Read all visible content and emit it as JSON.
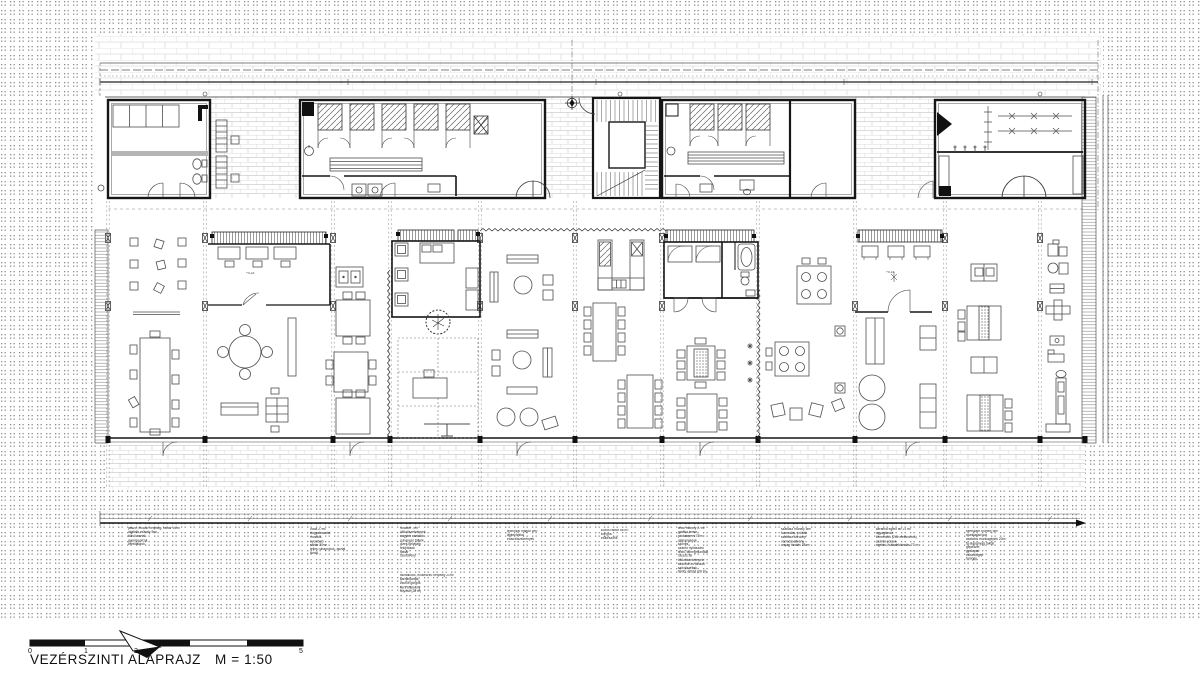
{
  "colors": {
    "ink": "#161616",
    "furniture": "#4d4d4d",
    "brick_light": "#dcdcdc",
    "brick_mid": "#cfcfcf",
    "halftone_dot": "#8d8d8d"
  },
  "footer": {
    "title": "VEZÉRSZINTI ALAPRAJZ",
    "scale": "M = 1:50"
  },
  "scale_bar": {
    "labels": [
      "0",
      "1",
      "2",
      "5"
    ]
  },
  "plan": {
    "elevation_marks": [
      {
        "label": "+0,15"
      },
      {
        "label": "+0,15"
      }
    ]
  },
  "annotations": {
    "columns": [
      {
        "x": 128,
        "y": 527,
        "lines": [
          "játszó, előadó helyiség, raktár 24m²",
          "digitális műhely 5m²",
          "külső asztal",
          "gyerekpolcok",
          "ventilátorok"
        ]
      },
      {
        "x": 310,
        "y": 528,
        "lines": [
          "iroda 27m²",
          "tárgyalóasztal",
          "mosdók",
          "nyomtató",
          "raktár 30m²",
          "teljes ruhapolcok, asztal",
          "tároló"
        ]
      },
      {
        "x": 400,
        "y": 527,
        "lines": [
          "fürdőtér 7m²",
          "öltözőszekrények",
          "nagytér asztalok",
          "zuhanyzó fülkék",
          "vizes helyiség",
          "felújítások",
          "raktár",
          "szerelvény"
        ]
      },
      {
        "x": 400,
        "y": 574,
        "lines": [
          "tisztálkodó, előkészítő helyiség 21m²",
          "karbantartás",
          "zsúfolt görgők",
          "kerti ültetvény",
          "folyosó (28 m)"
        ]
      },
      {
        "x": 507,
        "y": 530,
        "lines": [
          "technikai magok 5m²",
          "légtechnika",
          "elosztószekrények"
        ]
      },
      {
        "x": 601,
        "y": 529,
        "lines": [
          "közös raktár 56 m²",
          "konyha",
          "előkészítők"
        ]
      },
      {
        "x": 678,
        "y": 527,
        "lines": [
          "textil műhely 27m²",
          "grafika terem",
          "próbaterem 77m²",
          "alapanyagok",
          "szövés",
          "szárító nyílászáró",
          "textil, famegmunkáló",
          "rácsos fal",
          "öltözőszekrények",
          "szárítók és tárolók",
          "szövőszékek",
          "fürdő, öltöző (28 m)"
        ]
      },
      {
        "x": 781,
        "y": 528,
        "lines": [
          "szabász műhely 5m²",
          "fazonálás, próbák",
          "szabász kordony",
          "varrodai állvány",
          "anyag tárolás 28 m²"
        ]
      },
      {
        "x": 876,
        "y": 528,
        "lines": [
          "kerámia égető tér 21 m²",
          "agyagtároló",
          "kemencék (2db elektromos)",
          "szárító polcok",
          "égetés, hulladéktárolás 77 m²"
        ]
      },
      {
        "x": 966,
        "y": 530,
        "lines": [
          "szerszám műhely 5m²",
          "munkapad sor",
          "asztalos munkagépek 22m²",
          "fa alapanyag raktár",
          "gépészet",
          "gyalupad",
          "csiszológép",
          "fúrógép"
        ]
      }
    ]
  }
}
